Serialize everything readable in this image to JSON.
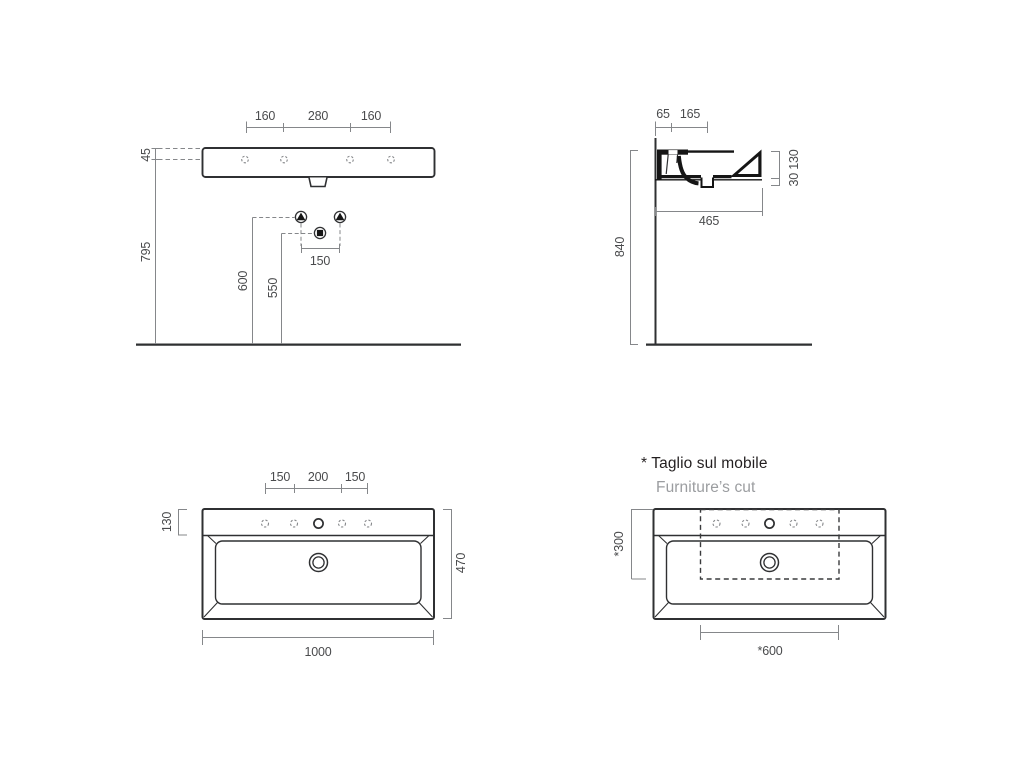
{
  "notes": {
    "furniture_cut_primary": "* Taglio sul mobile",
    "furniture_cut_secondary": "Furniture’s cut"
  },
  "front_view": {
    "tap_hole_spacing_left": "160",
    "tap_hole_spacing_center": "280",
    "tap_hole_spacing_right": "160",
    "rim_to_holes": "45",
    "rim_height_from_floor": "795",
    "fixing_height": "600",
    "trap_height": "550",
    "fixing_hole_spacing": "150"
  },
  "side_view": {
    "wall_to_front_ledge": "65",
    "wall_to_tap_hole": "165",
    "rim_height_from_floor": "840",
    "basin_depth": "465",
    "edge_thicknesses": "30 130"
  },
  "top_view": {
    "hole_spacing_left": "150",
    "hole_spacing_center": "200",
    "hole_spacing_right": "150",
    "deck_depth": "130",
    "total_depth": "470",
    "total_width": "1000"
  },
  "furniture_view": {
    "cut_depth": "*300",
    "cut_width": "*600"
  },
  "colors": {
    "drawing_line": "#2f3032",
    "dimension_line": "#85878a",
    "dimension_text": "#4a4b4d",
    "note_primary": "#231f20",
    "note_secondary": "#9b9da0",
    "background": "#ffffff"
  }
}
